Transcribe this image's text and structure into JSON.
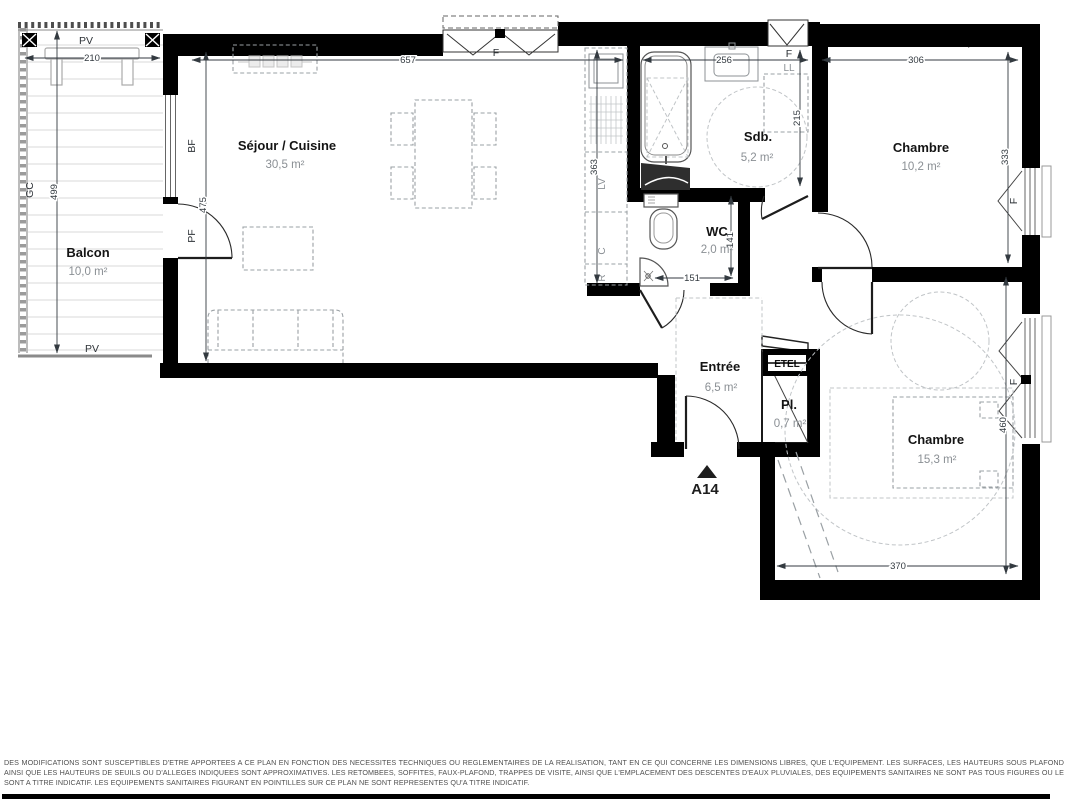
{
  "plan": {
    "unit": {
      "label": "A14"
    },
    "rooms": {
      "sejour": {
        "name": "Séjour / Cuisine",
        "area": "30,5 m²"
      },
      "balcon": {
        "name": "Balcon",
        "area": "10,0 m²"
      },
      "sdb": {
        "name": "Sdb.",
        "area": "5,2 m²"
      },
      "wc": {
        "name": "WC",
        "area": "2,0 m²"
      },
      "chambre1": {
        "name": "Chambre",
        "area": "10,2 m²"
      },
      "chambre2": {
        "name": "Chambre",
        "area": "15,3 m²"
      },
      "entree": {
        "name": "Entrée",
        "area": "6,5 m²"
      },
      "placard": {
        "name": "Pl.",
        "area": "0,7 m²"
      }
    },
    "dims": {
      "balcon_w": "210",
      "balcon_h": "499",
      "sejour_w": "657",
      "sejour_h": "475",
      "cuisine_h": "363",
      "sdb_w": "256",
      "sdb_h": "215",
      "wc_w": "151",
      "wc_h": "141",
      "chambre1_w": "306",
      "chambre1_h": "333",
      "chambre2_w": "370",
      "chambre2_h": "460"
    },
    "labels": {
      "pv": "PV",
      "gc": "GC",
      "bf": "BF",
      "pf": "PF",
      "window": "F",
      "washer": "LL",
      "dishwasher": "LV",
      "cooker": "C",
      "fridge": "R",
      "elec": "ETEL"
    },
    "colors": {
      "wall": "#000000",
      "dimension": "#333a40",
      "area_text": "#8a8f94",
      "furniture_dash": "#9aa0a4",
      "background": "#ffffff"
    }
  },
  "footer": {
    "disclaimer": "DES MODIFICATIONS SONT SUSCEPTIBLES D'ETRE APPORTEES A CE PLAN EN FONCTION DES NECESSITES TECHNIQUES OU REGLEMENTAIRES DE LA REALISATION, TANT EN CE QUI CONCERNE LES DIMENSIONS LIBRES, QUE L'EQUIPEMENT. LES SURFACES, LES HAUTEURS SOUS PLAFOND AINSI QUE LES HAUTEURS DE SEUILS OU D'ALLEGES INDIQUEES SONT APPROXIMATIVES. LES RETOMBEES, SOFFITES, FAUX-PLAFOND, TRAPPES DE VISITE, AINSI QUE L'EMPLACEMENT DES DESCENTES D'EAUX PLUVIALES, DES EQUIPEMENTS SANITAIRES NE SONT PAS TOUS FIGURES OU LE SONT A TITRE INDICATIF. LES EQUIPEMENTS SANITAIRES FIGURANT EN POINTILLES SUR CE PLAN NE SONT REPRESENTES QU'A TITRE INDICATIF."
  }
}
